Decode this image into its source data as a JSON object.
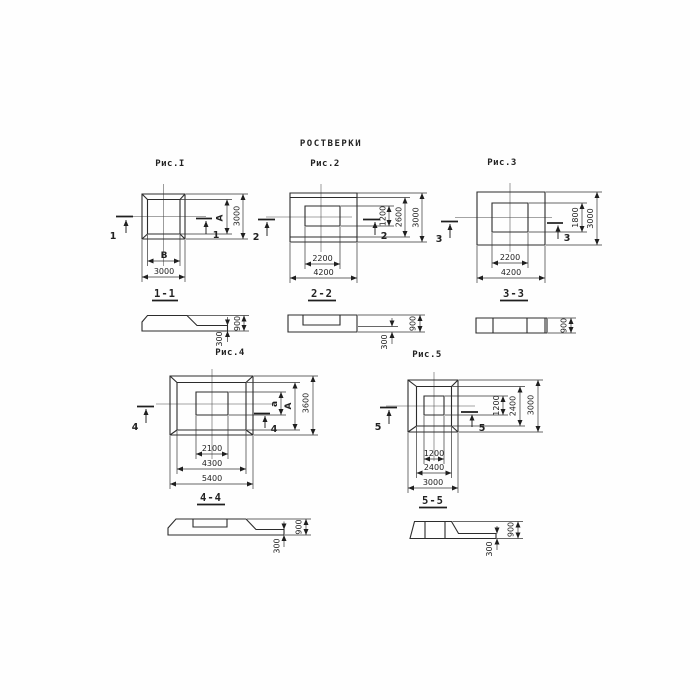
{
  "title": "РОСТВЕРКИ",
  "fig1": {
    "caption": "Рис.I",
    "cut": "1",
    "section_caption": "1-1",
    "dim_inner_w": "В",
    "dim_outer_w": "3000",
    "dim_inner_h": "А",
    "dim_outer_h": "3000",
    "sec_h_toe": "300",
    "sec_h_total": "900"
  },
  "fig2": {
    "caption": "Рис.2",
    "cut": "2",
    "section_caption": "2-2",
    "dim_inner_w": "2200",
    "dim_outer_w": "4200",
    "dim_inner_h": "1200",
    "dim_mid_h": "2600",
    "dim_outer_h": "3000",
    "sec_h_toe": "300",
    "sec_h_total": "900"
  },
  "fig3": {
    "caption": "Рис.3",
    "cut": "3",
    "section_caption": "3-3",
    "dim_inner_w": "2200",
    "dim_outer_w": "4200",
    "dim_inner_h": "1800",
    "dim_outer_h": "3000",
    "sec_h_total": "900"
  },
  "fig4": {
    "caption": "Рис.4",
    "cut": "4",
    "section_caption": "4-4",
    "dim_inner_w": "2100",
    "dim_mid_w": "4300",
    "dim_outer_w": "5400",
    "dim_inner_h": "а",
    "dim_mid_h": "А",
    "dim_outer_h": "3600",
    "sec_h_toe": "300",
    "sec_h_total": "900"
  },
  "fig5": {
    "caption": "Рис.5",
    "cut": "5",
    "section_caption": "5-5",
    "dim_inner_w": "1200",
    "dim_mid_w": "2400",
    "dim_outer_w": "3000",
    "dim_inner_h": "1200",
    "dim_mid_h": "2400",
    "dim_outer_h": "3000",
    "sec_h_toe": "300",
    "sec_h_total": "900"
  }
}
